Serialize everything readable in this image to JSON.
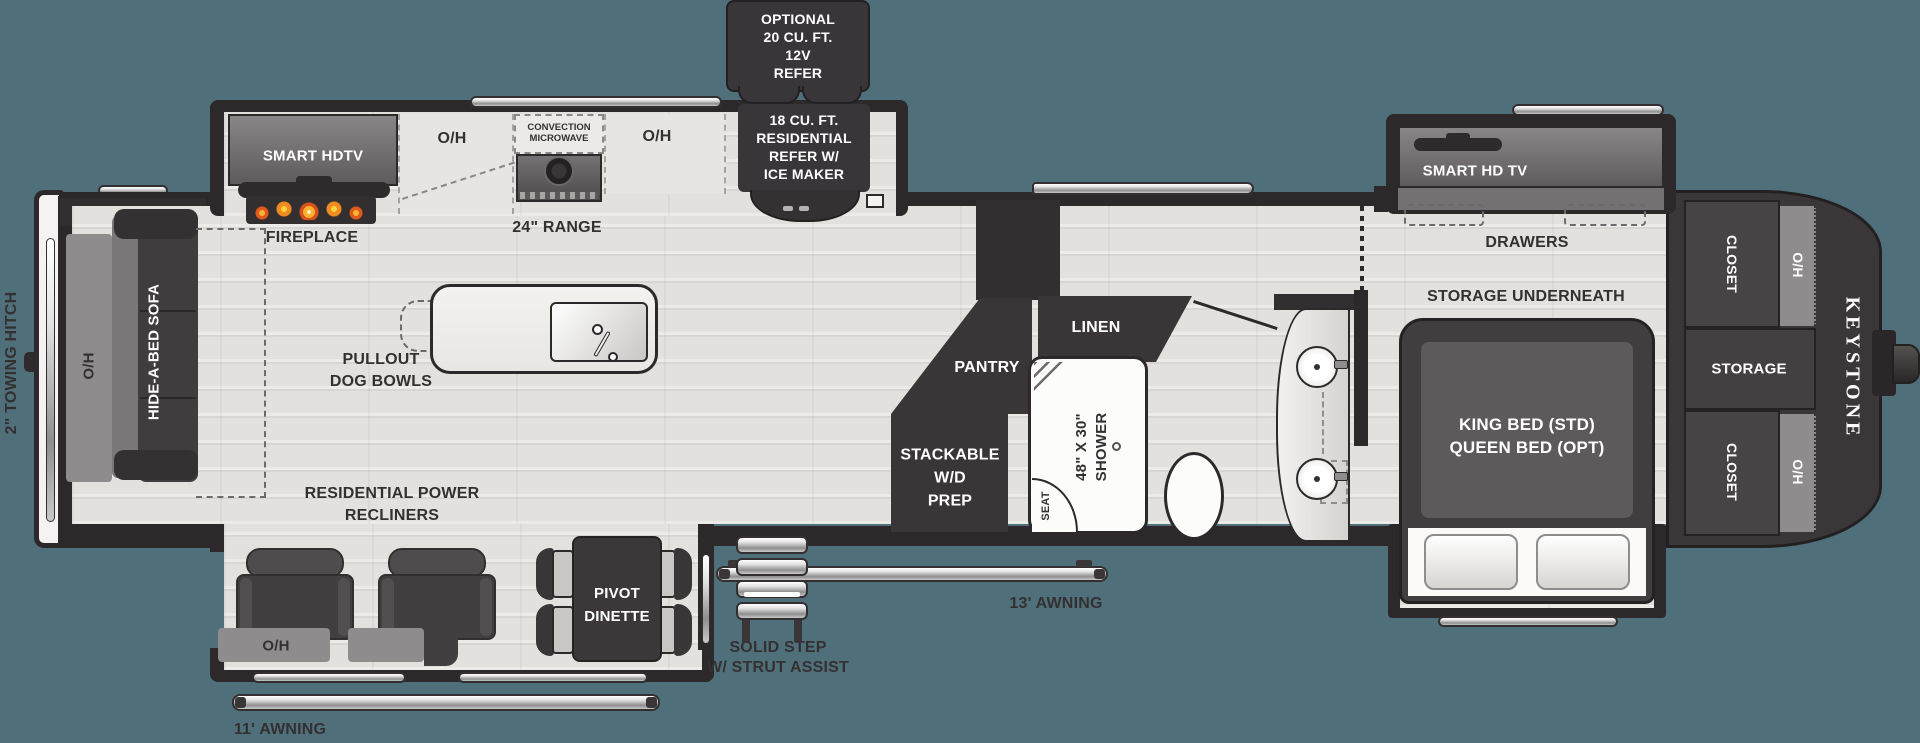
{
  "meta": {
    "title": "Keystone fifth-wheel RV floor plan",
    "background": "#4f707b"
  },
  "colors": {
    "background": "#4f707b",
    "wall": "#2d292a",
    "cabinet_dark": "#3a3637",
    "label": "#343031",
    "flame": "#e8701f"
  },
  "exterior": {
    "towing_hitch": "2\" TOWING HITCH",
    "brand": "KEYSTONE",
    "awning_11": "11' AWNING",
    "awning_13": "13' AWNING",
    "solid_step": [
      "SOLID STEP",
      "W/ STRUT ASSIST"
    ]
  },
  "callouts": {
    "optional_refer": [
      "OPTIONAL",
      "20 CU. FT.",
      "12V",
      "REFER"
    ],
    "residential_refer": [
      "18 CU. FT.",
      "RESIDENTIAL",
      "REFER W/",
      "ICE MAKER"
    ]
  },
  "kitchen": {
    "smart_hdtv": "SMART HDTV",
    "overhead_left": "O/H",
    "microwave": [
      "CONVECTION",
      "MICROWAVE"
    ],
    "overhead_right": "O/H",
    "fireplace": "FIREPLACE",
    "range": "24\" RANGE",
    "dog_bowls": [
      "PULLOUT",
      "DOG BOWLS"
    ]
  },
  "living": {
    "sofa": "HIDE-A-BED SOFA",
    "sofa_overhead": "O/H",
    "recliners": [
      "RESIDENTIAL POWER",
      "RECLINERS"
    ],
    "recliner_overhead": "O/H",
    "dinette": [
      "PIVOT",
      "DINETTE"
    ]
  },
  "utility": {
    "pantry": "PANTRY",
    "wd_prep": [
      "STACKABLE",
      "W/D",
      "PREP"
    ]
  },
  "bath": {
    "linen": "LINEN",
    "shower": [
      "48\" X 30\"",
      "SHOWER"
    ],
    "seat": "SEAT"
  },
  "bedroom": {
    "tv": "SMART HD TV",
    "drawers": "DRAWERS",
    "storage": "STORAGE UNDERNEATH",
    "bed": [
      "KING BED (STD)",
      "QUEEN BED (OPT)"
    ]
  },
  "front": {
    "closet_top": "CLOSET",
    "closet_top_oh": "O/H",
    "storage": "STORAGE",
    "closet_bottom": "CLOSET",
    "closet_bottom_oh": "O/H"
  }
}
